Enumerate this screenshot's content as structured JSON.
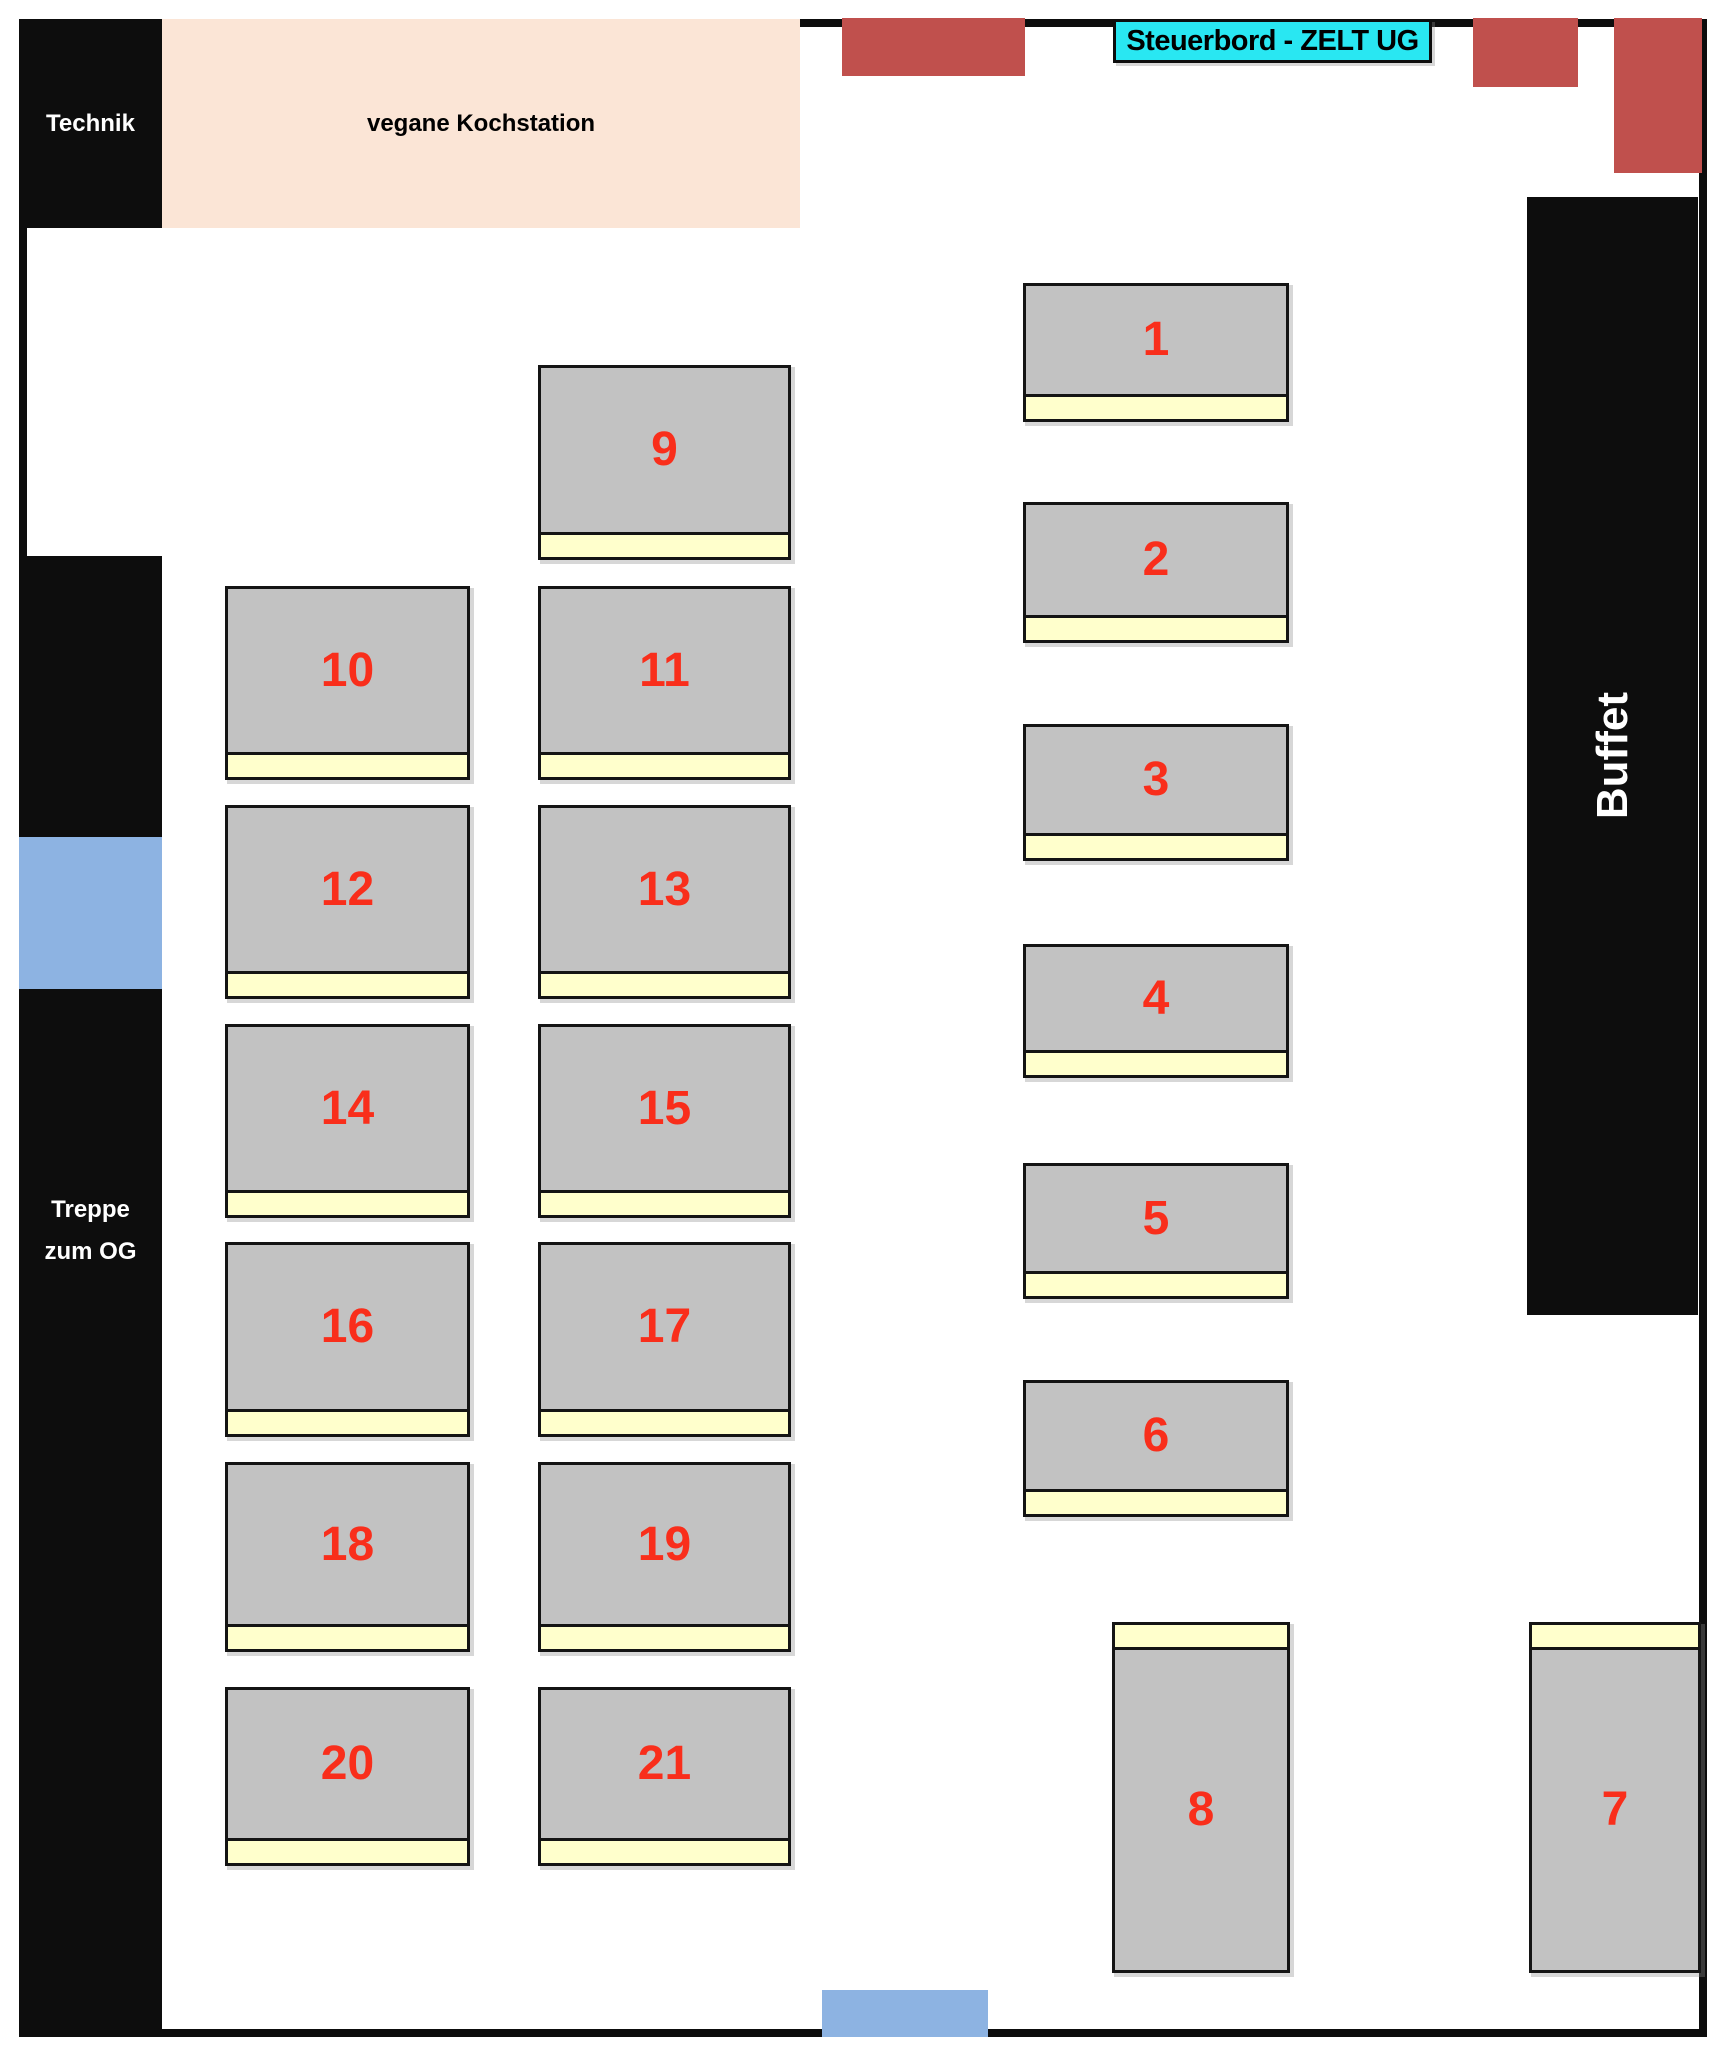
{
  "title": {
    "text": "Steuerbord - ZELT UG",
    "bg": "#29e7f2",
    "x": 1113,
    "y": 19,
    "w": 319,
    "h": 44
  },
  "colors": {
    "wall_black": "#0d0d0d",
    "zone_black": "#0d0d0d",
    "kitchen_peach": "#fbe5d6",
    "accent_red": "#c0504d",
    "door_blue": "#8db3e2",
    "table_gray": "#c2c2c2",
    "bench_yellow": "#ffffcc",
    "number_red": "#f92e1b",
    "label_white": "#ffffff",
    "label_black": "#000000"
  },
  "zones": [
    {
      "name": "technik-room",
      "label": "Technik",
      "fill": "#0d0d0d",
      "label_color": "#ffffff",
      "label_size": 24,
      "x": 19,
      "y": 19,
      "w": 143,
      "h": 209
    },
    {
      "name": "vegan-cooking-station",
      "label": "vegane Kochstation",
      "fill": "#fbe5d6",
      "label_color": "#000000",
      "label_size": 24,
      "x": 162,
      "y": 19,
      "w": 638,
      "h": 209
    },
    {
      "name": "buffet-counter",
      "label": "Buffet",
      "fill": "#0d0d0d",
      "label_color": "#ffffff",
      "label_size": 44,
      "vertical": true,
      "x": 1527,
      "y": 197,
      "w": 171,
      "h": 1118
    },
    {
      "name": "left-wall-upper-block",
      "fill": "#0d0d0d",
      "x": 19,
      "y": 556,
      "w": 143,
      "h": 281
    },
    {
      "name": "left-door-blue",
      "fill": "#8db3e2",
      "x": 19,
      "y": 837,
      "w": 143,
      "h": 152
    },
    {
      "name": "stairs-to-og",
      "label_lines": [
        "Treppe",
        "zum OG"
      ],
      "fill": "#0d0d0d",
      "label_color": "#ffffff",
      "label_size": 24,
      "label_pad": 200,
      "line_height": 42,
      "x": 19,
      "y": 989,
      "w": 143,
      "h": 1048
    },
    {
      "name": "red-block-top-center",
      "fill": "#c0504d",
      "x": 842,
      "y": 18,
      "w": 183,
      "h": 58
    },
    {
      "name": "red-block-top-right-1",
      "fill": "#c0504d",
      "x": 1473,
      "y": 18,
      "w": 105,
      "h": 69
    },
    {
      "name": "red-block-top-right-2",
      "fill": "#c0504d",
      "x": 1614,
      "y": 18,
      "w": 88,
      "h": 155
    },
    {
      "name": "bottom-door-blue",
      "fill": "#8db3e2",
      "x": 822,
      "y": 1990,
      "w": 166,
      "h": 47
    }
  ],
  "tables": [
    {
      "number": "1",
      "x": 1023,
      "y": 283,
      "w": 266,
      "h": 139,
      "strip": "bottom"
    },
    {
      "number": "2",
      "x": 1023,
      "y": 502,
      "w": 266,
      "h": 141,
      "strip": "bottom"
    },
    {
      "number": "3",
      "x": 1023,
      "y": 724,
      "w": 266,
      "h": 137,
      "strip": "bottom"
    },
    {
      "number": "4",
      "x": 1023,
      "y": 944,
      "w": 266,
      "h": 134,
      "strip": "bottom"
    },
    {
      "number": "5",
      "x": 1023,
      "y": 1163,
      "w": 266,
      "h": 136,
      "strip": "bottom"
    },
    {
      "number": "6",
      "x": 1023,
      "y": 1380,
      "w": 266,
      "h": 137,
      "strip": "bottom"
    },
    {
      "number": "7",
      "x": 1529,
      "y": 1622,
      "w": 172,
      "h": 351,
      "strip": "top"
    },
    {
      "number": "8",
      "x": 1112,
      "y": 1622,
      "w": 178,
      "h": 351,
      "strip": "top"
    },
    {
      "number": "9",
      "x": 538,
      "y": 365,
      "w": 253,
      "h": 195,
      "strip": "bottom"
    },
    {
      "number": "10",
      "x": 225,
      "y": 586,
      "w": 245,
      "h": 194,
      "strip": "bottom"
    },
    {
      "number": "11",
      "x": 538,
      "y": 586,
      "w": 253,
      "h": 194,
      "strip": "bottom"
    },
    {
      "number": "12",
      "x": 225,
      "y": 805,
      "w": 245,
      "h": 194,
      "strip": "bottom"
    },
    {
      "number": "13",
      "x": 538,
      "y": 805,
      "w": 253,
      "h": 194,
      "strip": "bottom"
    },
    {
      "number": "14",
      "x": 225,
      "y": 1024,
      "w": 245,
      "h": 194,
      "strip": "bottom"
    },
    {
      "number": "15",
      "x": 538,
      "y": 1024,
      "w": 253,
      "h": 194,
      "strip": "bottom"
    },
    {
      "number": "16",
      "x": 225,
      "y": 1242,
      "w": 245,
      "h": 195,
      "strip": "bottom"
    },
    {
      "number": "17",
      "x": 538,
      "y": 1242,
      "w": 253,
      "h": 195,
      "strip": "bottom"
    },
    {
      "number": "18",
      "x": 225,
      "y": 1462,
      "w": 245,
      "h": 190,
      "strip": "bottom"
    },
    {
      "number": "19",
      "x": 538,
      "y": 1462,
      "w": 253,
      "h": 190,
      "strip": "bottom"
    },
    {
      "number": "20",
      "x": 225,
      "y": 1687,
      "w": 245,
      "h": 179,
      "strip": "bottom"
    },
    {
      "number": "21",
      "x": 538,
      "y": 1687,
      "w": 253,
      "h": 179,
      "strip": "bottom"
    }
  ]
}
